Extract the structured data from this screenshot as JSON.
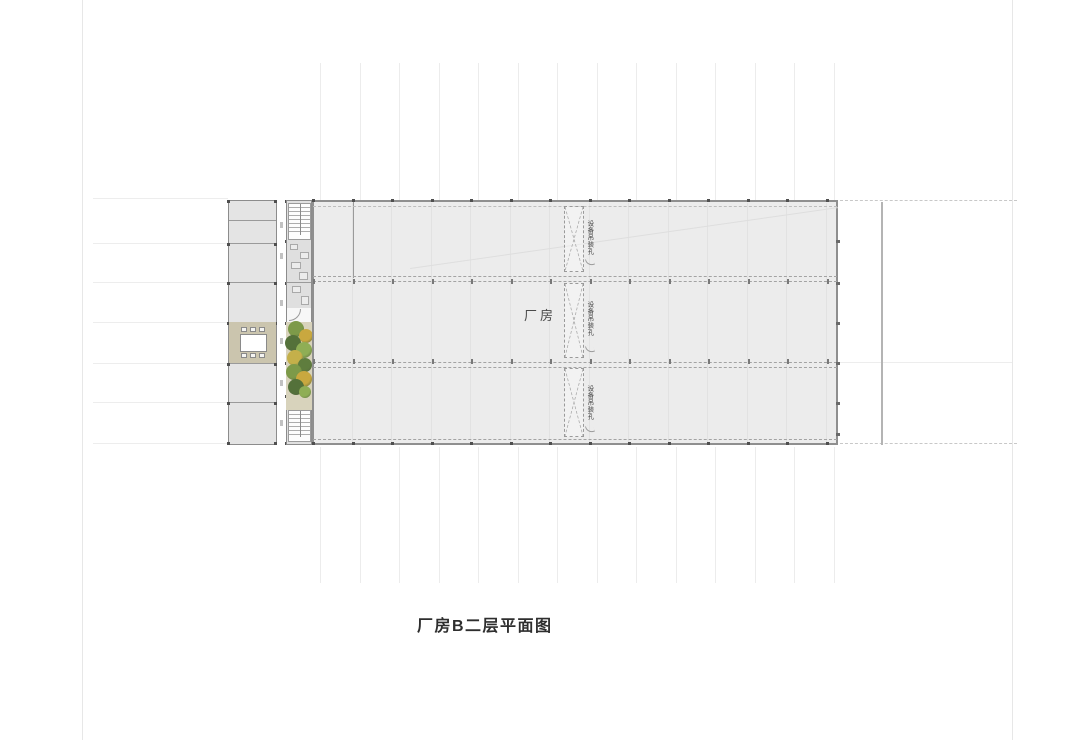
{
  "drawing": {
    "caption": "厂房B二层平面图",
    "hall_label": "厂房",
    "opening_label": "设备吊装孔"
  },
  "colors": {
    "hall_fill": "#ececec",
    "wing_fill": "#e4e4e4",
    "wall": "#8f8f8f",
    "conference_floor": "#cbc5ae",
    "terrace_fill": "#d8d3bc",
    "tree_green_dark": "#54713a",
    "tree_green": "#7d9a49",
    "tree_green_light": "#8fae55",
    "tree_yellow": "#c9a83f",
    "gridline_faint": "#ececec",
    "side_line": "#b4b4b4"
  }
}
